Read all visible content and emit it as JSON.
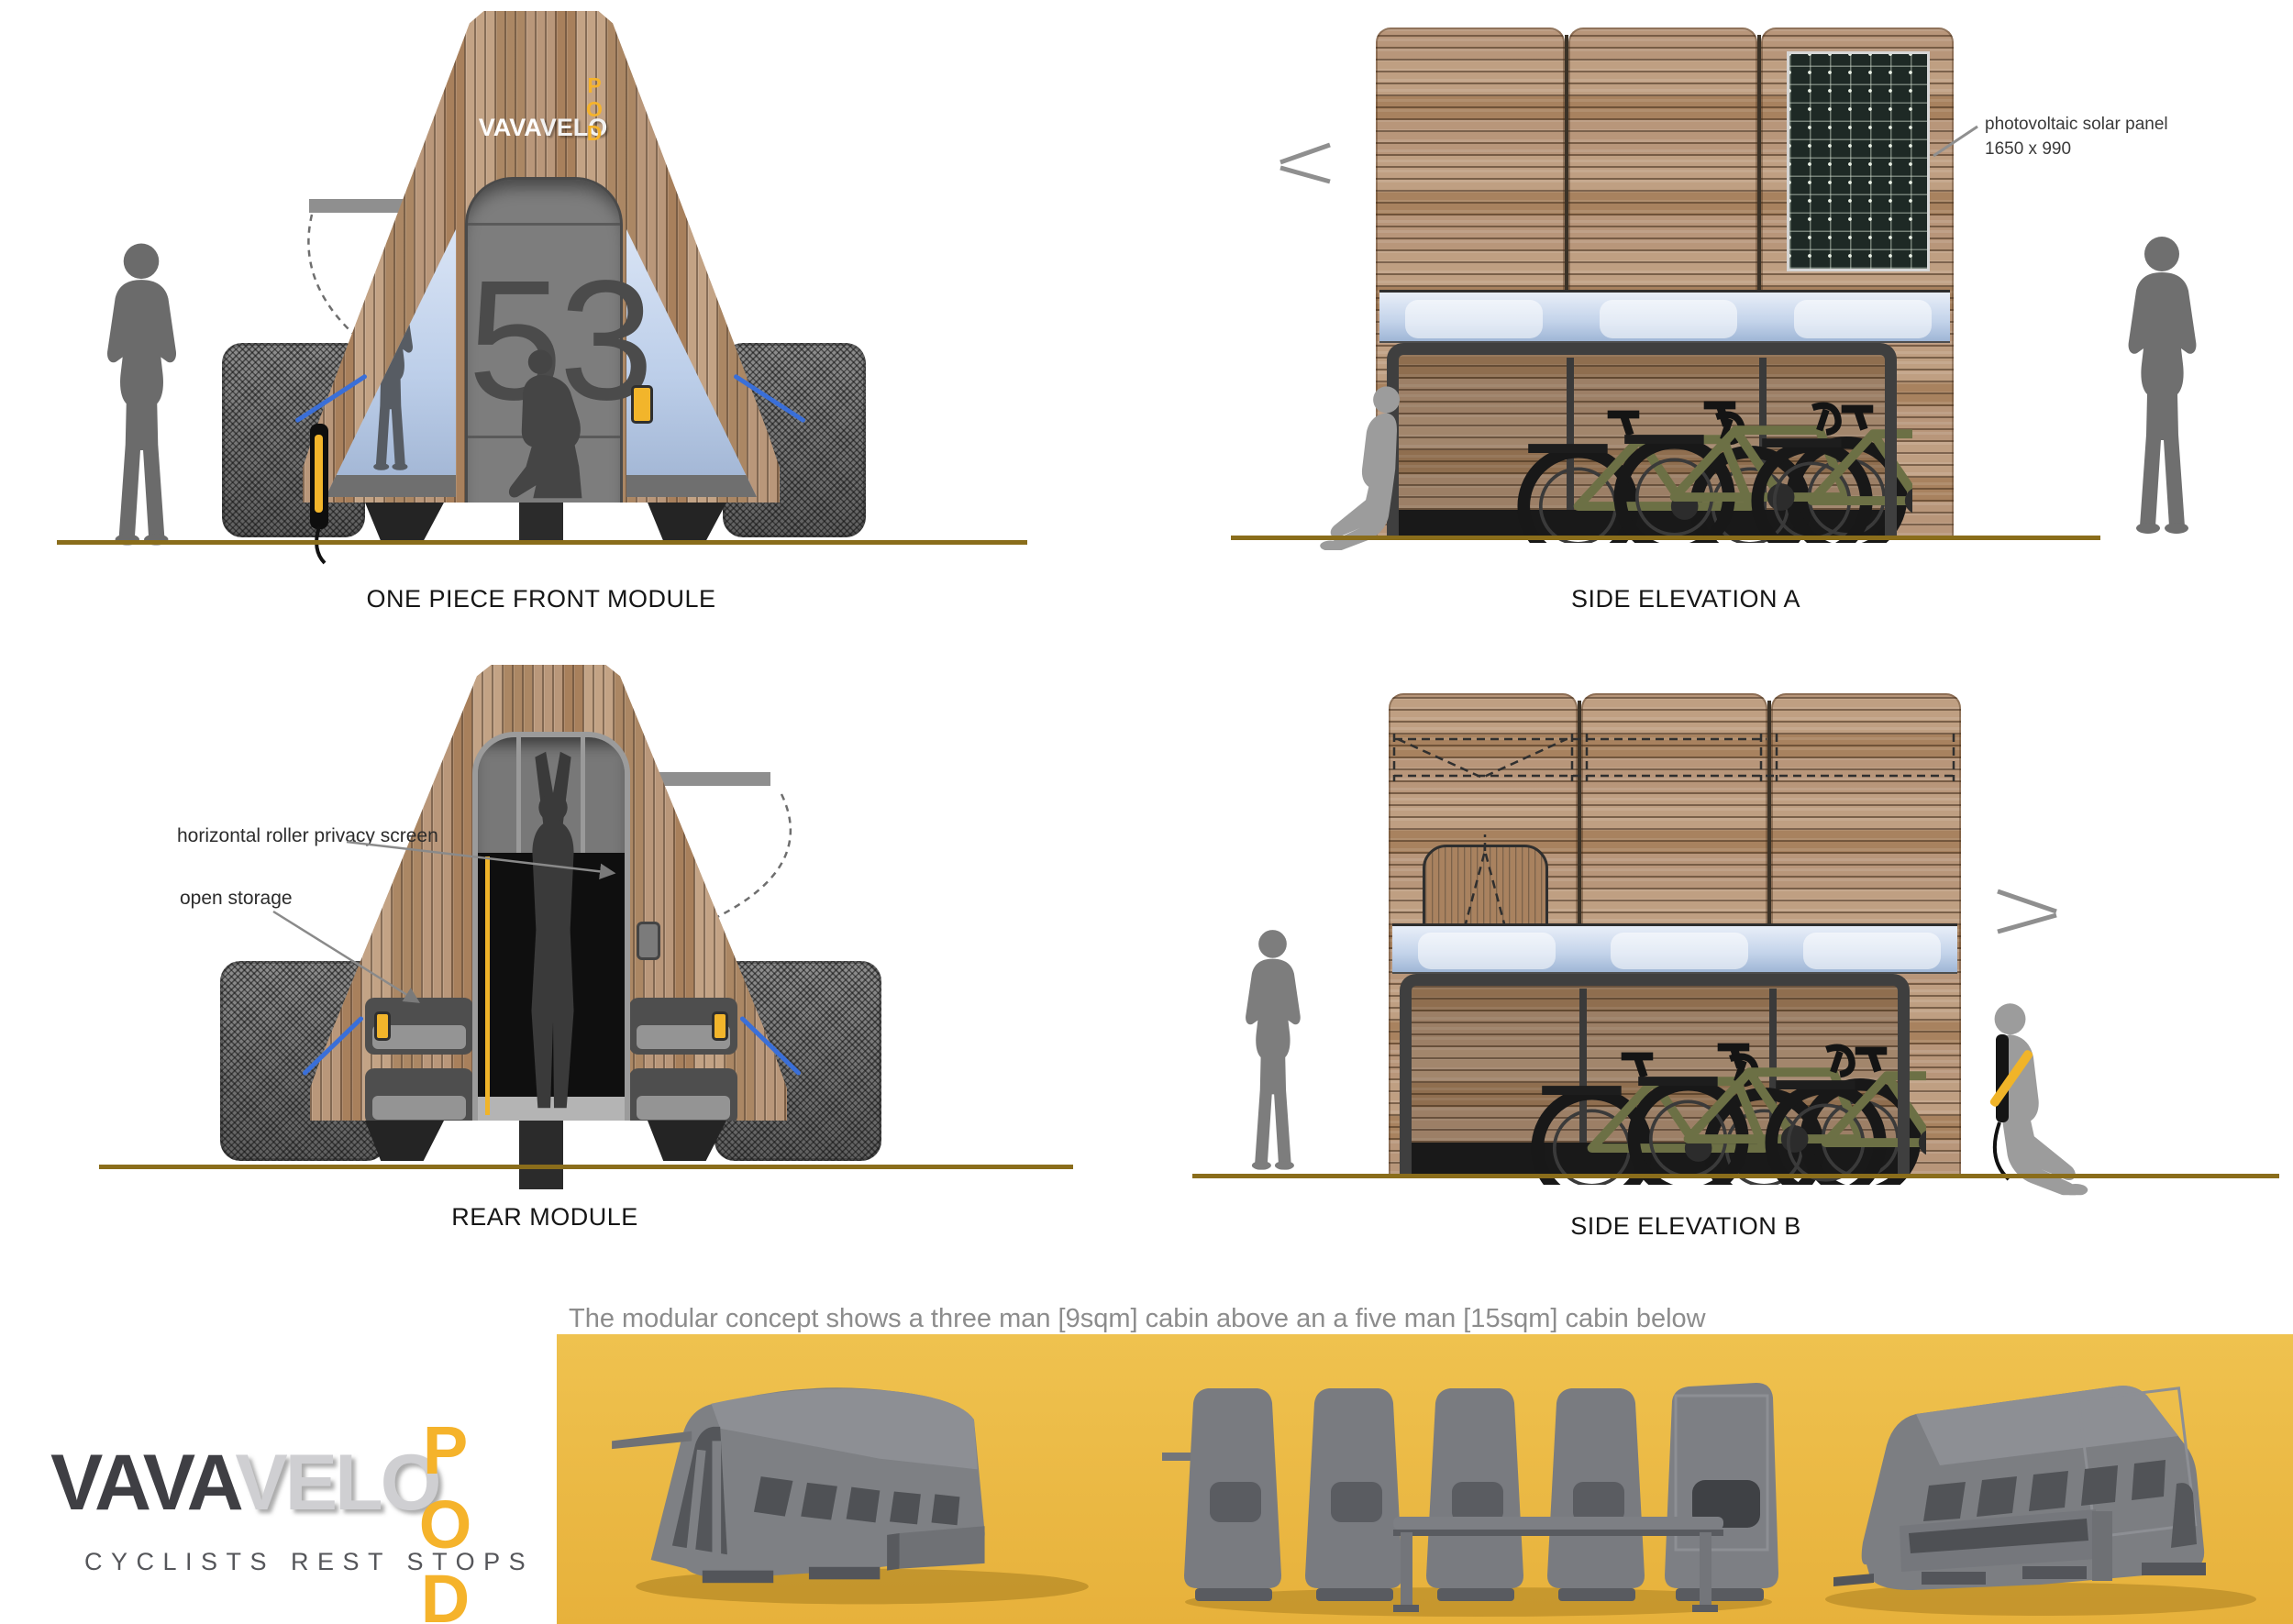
{
  "board": {
    "caption": "The modular concept shows a three man [9sqm] cabin above an a five man [15sqm] cabin below"
  },
  "front_module": {
    "label": "ONE PIECE FRONT MODULE",
    "pod_number": "53",
    "logo": {
      "vava": "VAVA",
      "velo": "VELO",
      "pod": "POD"
    }
  },
  "side_elevation_a": {
    "label": "SIDE ELEVATION A",
    "solar_annotation": {
      "line1": "photovoltaic solar panel",
      "line2": "1650 x 990"
    }
  },
  "rear_module": {
    "label": "REAR MODULE",
    "annotations": {
      "privacy_screen": "horizontal roller privacy screen",
      "open_storage": "open storage"
    }
  },
  "side_elevation_b": {
    "label": "SIDE ELEVATION B"
  },
  "footer_logo": {
    "vava": "VAVA",
    "velo": "VELO",
    "pod": "POD",
    "tagline": "CYCLISTS REST STOPS"
  },
  "colors": {
    "accent_yellow": "#F5B32B",
    "banner_yellow": "#EDBE4C",
    "ground_line": "#8a6d1b",
    "guide_blue": "#3a6fd8",
    "wood": "#b18d6b",
    "silhouette_gray": "#6e6e6e"
  }
}
